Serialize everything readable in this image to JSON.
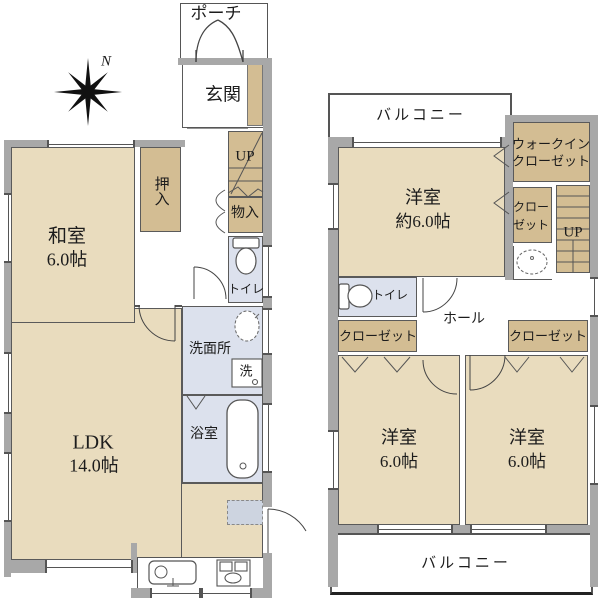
{
  "colors": {
    "room_fill": "#e9dcbe",
    "closet_fill": "#d3bd93",
    "wet_area_fill": "#dce1ed",
    "wall": "#a8a8a8",
    "fridge_space": "#cdd4e0",
    "line": "#555555",
    "text": "#1c1c1c"
  },
  "compass": {
    "north_label": "N"
  },
  "floor1": {
    "porch": "ポーチ",
    "entrance": "玄関",
    "closet_oshiire": "押入",
    "washitsu": {
      "name": "和室",
      "size": "6.0帖"
    },
    "stairs": "UP",
    "storage": "物入",
    "toilet": "トイレ",
    "washroom": "洗面所",
    "laundry": "洗",
    "bath": "浴室",
    "ldk": {
      "name": "LDK",
      "size": "14.0帖"
    }
  },
  "floor2": {
    "balcony_top": "バルコニー",
    "bedroom_top": {
      "name": "洋室",
      "size": "約6.0帖"
    },
    "walkin_closet": {
      "line1": "ウォークイン",
      "line2": "クローゼット"
    },
    "closet_small": {
      "line1": "クロー",
      "line2": "ゼット"
    },
    "stairs": "UP",
    "toilet": "トイレ",
    "hall": "ホール",
    "closet_left": "クローゼット",
    "closet_right": "クローゼット",
    "bedroom_left": {
      "name": "洋室",
      "size": "6.0帖"
    },
    "bedroom_right": {
      "name": "洋室",
      "size": "6.0帖"
    },
    "balcony_bottom": "バルコニー"
  }
}
